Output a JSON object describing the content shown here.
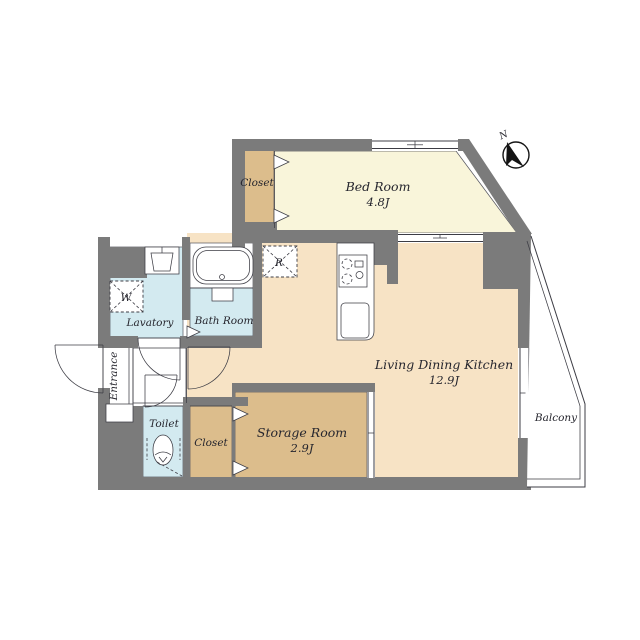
{
  "plan": {
    "rooms": {
      "bed_room": {
        "label": "Bed Room",
        "area": "4.8J"
      },
      "living_dining_kitchen": {
        "label": "Living Dining Kitchen",
        "area": "12.9J"
      },
      "storage_room": {
        "label": "Storage Room",
        "area": "2.9J"
      },
      "closet_upper": {
        "label": "Closet"
      },
      "closet_lower": {
        "label": "Closet"
      },
      "lavatory": {
        "label": "Lavatory"
      },
      "bath_room": {
        "label": "Bath Room"
      },
      "toilet": {
        "label": "Toilet"
      },
      "entrance": {
        "label": "Entrance"
      },
      "balcony": {
        "label": "Balcony"
      }
    },
    "markers": {
      "compass_north": "N",
      "washing_machine": "W",
      "refrigerator": "R"
    }
  },
  "colors": {
    "wall": "#7b7b7b",
    "bedroom_floor": "#f9f5da",
    "ldk_floor": "#f7e3c5",
    "tan_floor": "#dcbd8c",
    "wet_floor": "#d3eaf0",
    "line": "#3c3c44",
    "text": "#26262e",
    "background": "#ffffff"
  }
}
